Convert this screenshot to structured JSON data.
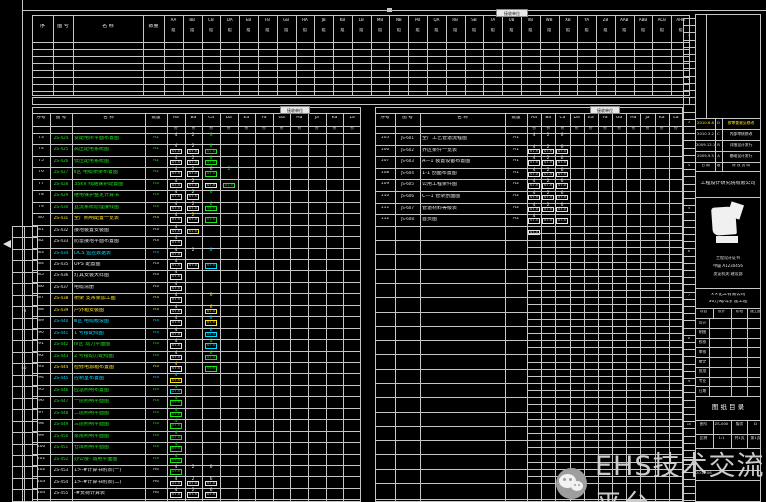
{
  "watermark": {
    "text": "EHS技术交流平台"
  },
  "frame": {
    "tick": "▪"
  },
  "top_table": {
    "label": "接收单位",
    "col_headers": [
      "序",
      "图 号",
      "名  称",
      "数量"
    ],
    "group_suffix": "组",
    "group_codes": [
      "AA",
      "BB",
      "CB",
      "DA",
      "EB",
      "FB",
      "GB",
      "HA",
      "JB",
      "KB",
      "LB",
      "MB",
      "NB",
      "PB",
      "QA",
      "RB",
      "SB",
      "TA",
      "UB",
      "VB",
      "WB",
      "XB",
      "YA",
      "ZB",
      "AAB",
      "ABB",
      "ACB",
      "AHB"
    ],
    "empty_rows": 7
  },
  "grid_codes": [
    "Aa",
    "Ba",
    "Ca",
    "Da",
    "Ea",
    "Fa",
    "Ga",
    "Ha",
    "Ja",
    "Ka",
    "La"
  ],
  "grid_sub_mark": "份",
  "left_table": {
    "label": "接收单位",
    "col_headers": [
      "序号",
      "图 号",
      "名  称",
      "数量"
    ],
    "rows": [
      {
        "no": "73",
        "code": "ZS-424",
        "name": "变配电所平面布置图",
        "scale": "A2",
        "color": "g",
        "cells": [
          {
            "c": 0,
            "t": "4",
            "b": "07.5",
            "k": "w"
          },
          {
            "c": 1,
            "t": "2",
            "b": "07.5",
            "k": "w"
          },
          {
            "c": 2,
            "t": "6",
            "b": "07.5",
            "k": "g"
          }
        ]
      },
      {
        "no": "74",
        "code": "ZS-425",
        "name": "高压配电系统图",
        "scale": "A2",
        "color": "g",
        "cells": [
          {
            "c": 0,
            "t": "4",
            "b": "07.5",
            "k": "w"
          },
          {
            "c": 1,
            "t": "2",
            "b": "07.5",
            "k": "w"
          },
          {
            "c": 2,
            "t": "6",
            "b": "07.5",
            "k": "g"
          }
        ]
      },
      {
        "no": "75",
        "code": "ZS-426",
        "name": "低压配电系统图",
        "scale": "A2",
        "color": "g",
        "cells": [
          {
            "c": 0,
            "t": "4",
            "b": "07.5",
            "k": "w"
          },
          {
            "c": 1,
            "t": "2",
            "b": "07.5",
            "k": "w"
          },
          {
            "c": 2,
            "t": "6",
            "b": "07.5",
            "k": "g"
          }
        ]
      },
      {
        "no": "76",
        "code": "ZS-427",
        "name": "Ⅱ区 电缆桥架布置图",
        "scale": "A2",
        "color": "g",
        "cells": [
          {
            "c": 0,
            "t": "4",
            "b": "07.5",
            "k": "w"
          },
          {
            "c": 1,
            "t": "2",
            "b": "07.5",
            "k": "w"
          },
          {
            "c": 2,
            "t": "6",
            "b": "07.5",
            "k": "w"
          },
          {
            "c": 3,
            "t": "2",
            "b": "07.5",
            "k": "g"
          }
        ]
      },
      {
        "no": "77",
        "code": "ZS-428",
        "name": "35kV 线路保护配置图",
        "scale": "A3",
        "color": "g",
        "cells": [
          {
            "c": 0,
            "t": "4",
            "b": "07.5",
            "k": "w"
          },
          {
            "c": 1,
            "t": "2",
            "b": "07.5",
            "k": "w"
          }
        ]
      },
      {
        "no": "78",
        "code": "ZS-429",
        "name": "继电保护整定计算书",
        "scale": "A3",
        "color": "g",
        "cells": [
          {
            "c": 0,
            "t": "4",
            "b": "07.5",
            "k": "w"
          },
          {
            "c": 1,
            "t": "2",
            "b": "07.5",
            "k": "w"
          },
          {
            "c": 2,
            "t": "6",
            "b": "07.5",
            "k": "g"
          }
        ]
      },
      {
        "no": "79",
        "code": "ZS-430",
        "name": "直流系统原理接线图",
        "scale": "A3",
        "color": "g",
        "cells": [
          {
            "c": 0,
            "t": "4",
            "b": "07.5",
            "k": "w"
          },
          {
            "c": 1,
            "t": "2",
            "b": "07.5",
            "k": "w"
          },
          {
            "c": 2,
            "t": "6",
            "b": "07.5",
            "k": "g"
          }
        ]
      },
      {
        "no": "80",
        "code": "ZS-431",
        "name": "全厂照明配置一览表",
        "scale": "A3",
        "color": "y",
        "cells": [
          {
            "c": 0,
            "t": "4",
            "b": "07.5",
            "k": "w"
          },
          {
            "c": 1,
            "t": "2",
            "b": "07.5",
            "k": "y"
          }
        ]
      },
      {
        "no": "81",
        "code": "ZS-432",
        "name": "接地装置安装图",
        "scale": "A3",
        "color": "w",
        "cells": [
          {
            "c": 0,
            "t": "4",
            "b": "07.5",
            "k": "w"
          }
        ]
      },
      {
        "no": "82",
        "code": "ZS-433",
        "name": "防雷接地平面布置图",
        "scale": "A3",
        "color": "w",
        "cells": [
          {
            "c": 0,
            "t": "4",
            "b": "07.5",
            "k": "w"
          }
        ]
      },
      {
        "no": "83",
        "code": "ZS-434",
        "name": "DCS 监控数据表",
        "scale": "A3",
        "color": "c",
        "cells": [
          {
            "c": 0,
            "t": "4",
            "b": "07.5",
            "k": "w"
          },
          {
            "c": 1,
            "t": "2",
            "b": "07.5",
            "k": "w"
          },
          {
            "c": 2,
            "t": "6",
            "b": "07.5",
            "k": "c"
          }
        ]
      },
      {
        "no": "84",
        "code": "ZS-435",
        "name": "UPS 配置图",
        "scale": "A3",
        "color": "w",
        "cells": [
          {
            "c": 0,
            "t": "4",
            "b": "07.5",
            "k": "w"
          }
        ]
      },
      {
        "no": "85",
        "code": "ZS-436",
        "name": "灯具安装大样图",
        "scale": "A3",
        "color": "w",
        "cells": [
          {
            "c": 0,
            "t": "4",
            "b": "07.5",
            "k": "w"
          }
        ]
      },
      {
        "no": "86",
        "code": "ZS-437",
        "name": "电缆清册",
        "scale": "A3",
        "color": "w",
        "cells": [
          {
            "c": 0,
            "t": "4",
            "b": "07.5",
            "k": "w"
          }
        ]
      },
      {
        "no": "87",
        "code": "ZS-438",
        "name": "桥架 支吊架加工图",
        "scale": "A3",
        "color": "y",
        "cells": [
          {
            "c": 0,
            "t": "4",
            "b": "07.5",
            "k": "w"
          },
          {
            "c": 2,
            "t": "6",
            "b": "07.5",
            "k": "y"
          }
        ]
      },
      {
        "no": "88",
        "code": "ZS-439",
        "name": "户外箱安装图",
        "scale": "A3",
        "color": "y",
        "cells": [
          {
            "c": 0,
            "t": "4",
            "b": "07.5",
            "k": "w"
          },
          {
            "c": 2,
            "t": "6",
            "b": "07.5",
            "k": "y"
          }
        ]
      },
      {
        "no": "89",
        "code": "ZS-440",
        "name": "Ⅲ区 电缆敷设图",
        "scale": "A3",
        "color": "c",
        "cells": [
          {
            "c": 0,
            "t": "4",
            "b": "07.5",
            "k": "w"
          },
          {
            "c": 2,
            "t": "6",
            "b": "07.5",
            "k": "c"
          }
        ]
      },
      {
        "no": "90",
        "code": "ZS-441",
        "name": "1 号楼配线图",
        "scale": "A3",
        "color": "c",
        "cells": [
          {
            "c": 0,
            "t": "4",
            "b": "07.5",
            "k": "w"
          },
          {
            "c": 2,
            "t": "6",
            "b": "07.5",
            "k": "c"
          }
        ]
      },
      {
        "no": "91",
        "code": "ZS-442",
        "name": "Ⅳ区 动力平面图",
        "scale": "A3",
        "color": "g",
        "cells": [
          {
            "c": 0,
            "t": "4",
            "b": "07.5",
            "k": "w"
          },
          {
            "c": 2,
            "t": "6",
            "b": "07.5",
            "k": "g"
          }
        ]
      },
      {
        "no": "92",
        "code": "ZS-443",
        "name": "2 号楼动力配线图",
        "scale": "A3",
        "color": "g",
        "cells": [
          {
            "c": 0,
            "t": "4",
            "b": "07.5",
            "k": "w"
          },
          {
            "c": 2,
            "t": "6",
            "b": "07.5",
            "k": "g"
          }
        ]
      },
      {
        "no": "93",
        "code": "ZS-444",
        "name": "检修电源箱布置图",
        "scale": "A3",
        "color": "y",
        "cells": [
          {
            "c": 0,
            "t": "4",
            "b": "07.5",
            "k": "y"
          }
        ]
      },
      {
        "no": "94",
        "code": "ZS-445",
        "name": "控制室布置图",
        "scale": "A3",
        "color": "c",
        "cells": [
          {
            "c": 0,
            "t": "4",
            "b": "07.5",
            "k": "c"
          }
        ]
      },
      {
        "no": "95",
        "code": "ZS-446",
        "name": "应急照明布置图",
        "scale": "A3",
        "color": "g",
        "cells": [
          {
            "c": 0,
            "t": "4",
            "b": "07.5",
            "k": "g"
          }
        ]
      },
      {
        "no": "96",
        "code": "ZS-447",
        "name": "一层照明平面图",
        "scale": "A3",
        "color": "g",
        "cells": [
          {
            "c": 0,
            "t": "4",
            "b": "07.5",
            "k": "g"
          }
        ]
      },
      {
        "no": "97",
        "code": "ZS-448",
        "name": "二层照明平面图",
        "scale": "A3",
        "color": "g",
        "cells": [
          {
            "c": 0,
            "t": "4",
            "b": "07.5",
            "k": "g"
          }
        ]
      },
      {
        "no": "98",
        "code": "ZS-449",
        "name": "三层照明平面图",
        "scale": "A3",
        "color": "g",
        "cells": [
          {
            "c": 0,
            "t": "4",
            "b": "07.5",
            "k": "g"
          }
        ]
      },
      {
        "no": "99",
        "code": "ZS-450",
        "name": "泵房照明平面图",
        "scale": "A3",
        "color": "g",
        "cells": [
          {
            "c": 0,
            "t": "4",
            "b": "07.5",
            "k": "g"
          }
        ]
      },
      {
        "no": "100",
        "code": "ZS-451",
        "name": "仓库照明平面图",
        "scale": "A3",
        "color": "g",
        "cells": [
          {
            "c": 0,
            "t": "4",
            "b": "07.5",
            "k": "g"
          }
        ]
      },
      {
        "no": "101",
        "code": "ZS-452",
        "name": "办公楼- 弱电平面图",
        "scale": "A3",
        "color": "g",
        "cells": [
          {
            "c": 0,
            "t": "4",
            "b": "07.5",
            "k": "g"
          }
        ]
      },
      {
        "no": "102",
        "code": "ZS-453",
        "name": "1>-#计算书附表(一)",
        "scale": "A4",
        "color": "w",
        "cells": [
          {
            "c": 0,
            "t": "4",
            "b": "07.5",
            "k": "w"
          },
          {
            "c": 1,
            "t": "2",
            "b": "07.5",
            "k": "w"
          },
          {
            "c": 2,
            "t": "6",
            "b": "07.5",
            "k": "w"
          }
        ]
      },
      {
        "no": "103",
        "code": "ZS-454",
        "name": "1>-#计算书附表(二)",
        "scale": "A4",
        "color": "w",
        "cells": [
          {
            "c": 0,
            "t": "4",
            "b": "07.5",
            "k": "w"
          },
          {
            "c": 1,
            "t": "2",
            "b": "07.5",
            "k": "w"
          },
          {
            "c": 2,
            "t": "6",
            "b": "07.5",
            "k": "w"
          }
        ]
      },
      {
        "no": "104",
        "code": "ZS-455",
        "name": "-#负荷计算表",
        "scale": "A4",
        "color": "w",
        "cells": [
          {
            "c": 0,
            "t": "4",
            "b": "07.5",
            "k": "w"
          },
          {
            "c": 1,
            "t": "2",
            "b": "07.5",
            "k": "w"
          },
          {
            "c": 2,
            "t": "6",
            "b": "07.5",
            "k": "w"
          }
        ]
      }
    ]
  },
  "right_table": {
    "label": "接收单位",
    "col_headers": [
      "序号",
      "图 号",
      "名  称",
      "数量"
    ],
    "rows": [
      {
        "no": "105",
        "code": "JS-601",
        "name": "全厂工艺管道流程图",
        "scale": "A1",
        "color": "w",
        "cells": [
          {
            "c": 0,
            "t": "4",
            "b": "07.5",
            "k": "w"
          },
          {
            "c": 1,
            "t": "2",
            "b": "07.5",
            "k": "w"
          },
          {
            "c": 2,
            "t": "6",
            "b": "07.5",
            "k": "w"
          }
        ]
      },
      {
        "no": "106",
        "code": "JS-602",
        "name": "界区条件一览表",
        "scale": "A1",
        "color": "w",
        "cells": [
          {
            "c": 0,
            "t": "4",
            "b": "07.5",
            "k": "w"
          },
          {
            "c": 1,
            "t": "2",
            "b": "07.5",
            "k": "w"
          },
          {
            "c": 2,
            "t": "6",
            "b": "07.5",
            "k": "w"
          }
        ]
      },
      {
        "no": "107",
        "code": "JS-603",
        "name": "A—1 装置设备布置图",
        "scale": "A1",
        "color": "w",
        "cells": [
          {
            "c": 0,
            "t": "4",
            "b": "07.5",
            "k": "w"
          },
          {
            "c": 1,
            "t": "2",
            "b": "07.5",
            "k": "w"
          },
          {
            "c": 2,
            "t": "6",
            "b": "07.5",
            "k": "w"
          }
        ]
      },
      {
        "no": "108",
        "code": "JS-604",
        "name": "1-1 剖面布置图",
        "scale": "A1",
        "color": "w",
        "cells": [
          {
            "c": 0,
            "t": "4",
            "b": "07.5",
            "k": "w"
          },
          {
            "c": 1,
            "t": "2",
            "b": "07.5",
            "k": "w"
          },
          {
            "c": 2,
            "t": "6",
            "b": "07.5",
            "k": "w"
          }
        ]
      },
      {
        "no": "109",
        "code": "JS-605",
        "name": "公用工程条件图",
        "scale": "A2",
        "color": "w",
        "cells": [
          {
            "c": 0,
            "t": "4",
            "b": "07.5",
            "k": "w"
          },
          {
            "c": 1,
            "t": "2",
            "b": "07.5",
            "k": "w"
          },
          {
            "c": 2,
            "t": "6",
            "b": "07.5",
            "k": "w"
          }
        ]
      },
      {
        "no": "110",
        "code": "JS-606",
        "name": "C—1 管架剖面图",
        "scale": "A2",
        "color": "w",
        "cells": [
          {
            "c": 0,
            "t": "4",
            "b": "07.5",
            "k": "w"
          },
          {
            "c": 1,
            "t": "2",
            "b": "07.5",
            "k": "w"
          },
          {
            "c": 2,
            "t": "6",
            "b": "07.5",
            "k": "w"
          }
        ]
      },
      {
        "no": "111",
        "code": "JS-607",
        "name": "管道材料等级表",
        "scale": "A2",
        "color": "w",
        "cells": [
          {
            "c": 0,
            "t": "4",
            "b": "07.5",
            "k": "w"
          },
          {
            "c": 1,
            "t": "2",
            "b": "07.5",
            "k": "w"
          },
          {
            "c": 2,
            "t": "6",
            "b": "07.5",
            "k": "w"
          }
        ]
      },
      {
        "no": "112",
        "code": "JS-608",
        "name": "首页图",
        "scale": "A2",
        "color": "w",
        "cells": [
          {
            "c": 0,
            "t": "4",
            "b": "07.5",
            "k": "w"
          }
        ]
      }
    ]
  },
  "title_block": {
    "revisions": [
      {
        "date": "2010.6.8",
        "rev": "D",
        "desc": "按审查意见修改",
        "color": "y"
      },
      {
        "date": "2010.3.2",
        "rev": "C",
        "desc": "内部审核修改",
        "color": "w"
      },
      {
        "date": "2009.12.1",
        "rev": "B",
        "desc": "详细设计发行",
        "color": "w"
      },
      {
        "date": "2009.9.5",
        "rev": "A",
        "desc": "基础设计发行",
        "color": "w"
      }
    ],
    "rev_header": [
      "日 期",
      "版",
      "修 改 说 明"
    ],
    "institute": "工程设计研究院有限公司",
    "stamp_lines": [
      "工程设计证书",
      "甲级 A1230456",
      "发证机关:建设部"
    ],
    "project_lines": [
      "××化工有限公司",
      "30万吨/年扩建工程"
    ],
    "mini_row": [
      "项目",
      "设计",
      "阶段",
      "施工图"
    ],
    "sig_labels": [
      "设计",
      "制图",
      "校核",
      "审核",
      "审定",
      "批准",
      "专业",
      "日期"
    ],
    "drawing_title": "图 纸 目 录",
    "num_rows": [
      [
        "图号",
        "ZS-000",
        "版次",
        "D"
      ],
      [
        "比例",
        "1:1",
        "共1页",
        "第1页"
      ]
    ],
    "foot": "2010.06"
  },
  "ladder_marks": [
    "1",
    "2",
    "3",
    "4",
    "5",
    "6",
    "7",
    "8",
    "9",
    "10",
    "11",
    "12"
  ],
  "left_strip_marks": [
    "F3",
    "E6"
  ]
}
